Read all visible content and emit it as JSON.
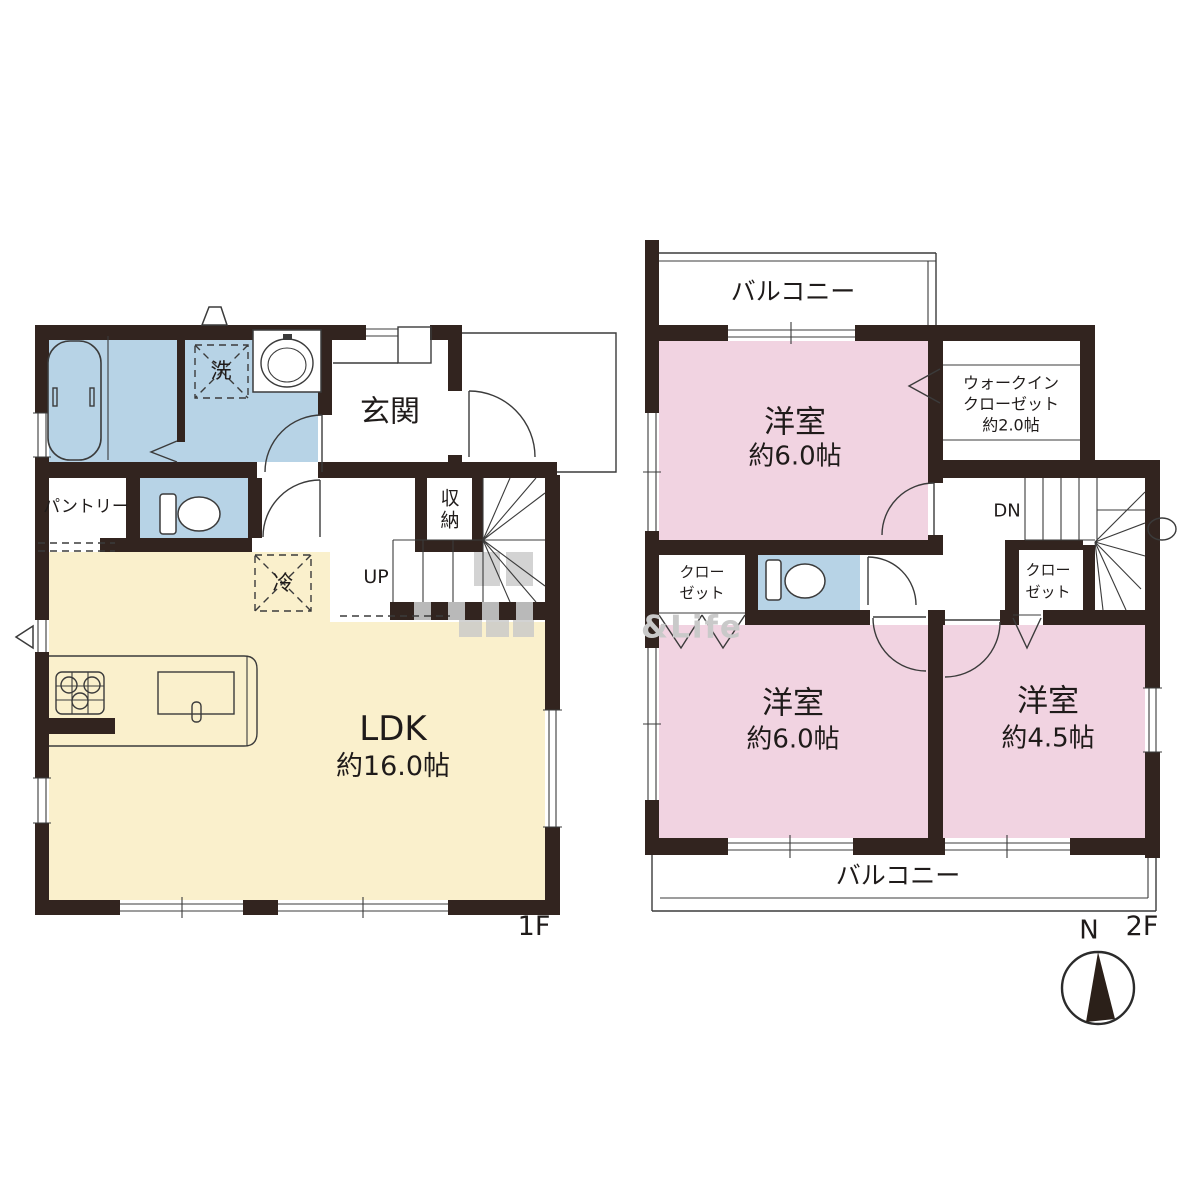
{
  "colors": {
    "wall": "#32241f",
    "water_blue": "#b7d3e6",
    "ldk_cream": "#faf0cc",
    "bedroom_pink": "#f1d3e1",
    "watermark_gray": "#c9c9c9"
  },
  "watermark": "&Life",
  "floor1": {
    "label": "1F",
    "entrance": "玄関",
    "pantry": "パントリー",
    "storage": "収納",
    "stairs_up": "UP",
    "laundry": "洗",
    "fridge": "冷",
    "ldk_name": "LDK",
    "ldk_size": "約16.0帖"
  },
  "floor2": {
    "label": "2F",
    "balcony_top": "バルコニー",
    "balcony_bottom": "バルコニー",
    "room_top_name": "洋室",
    "room_top_size": "約6.0帖",
    "wic_line1": "ウォークイン",
    "wic_line2": "クローゼット",
    "wic_size": "約2.0帖",
    "stairs_down": "DN",
    "closet_left_line1": "クロー",
    "closet_left_line2": "ゼット",
    "closet_right_line1": "クロー",
    "closet_right_line2": "ゼット",
    "room_bottom_left_name": "洋室",
    "room_bottom_left_size": "約6.0帖",
    "room_bottom_right_name": "洋室",
    "room_bottom_right_size": "約4.5帖",
    "compass_north": "N"
  }
}
